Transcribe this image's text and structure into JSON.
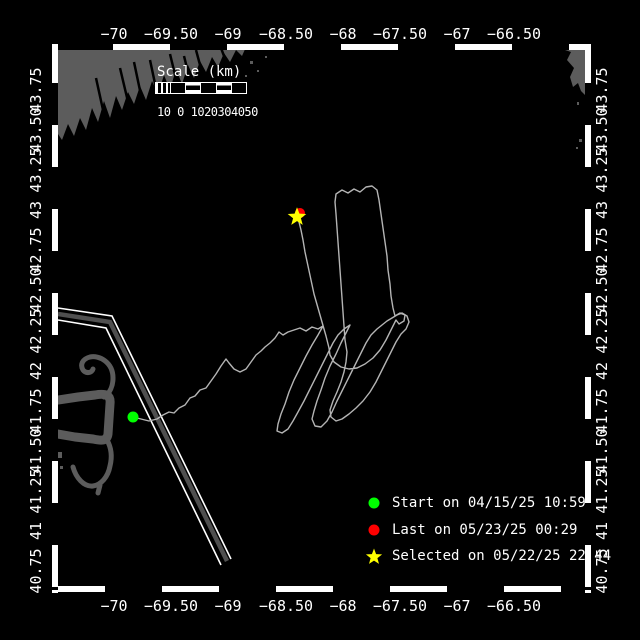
{
  "map": {
    "bg": "#000000",
    "land_color": "#5c5c5c",
    "track_color": "#b4b4b4",
    "lane_gray": "#4f4f4f",
    "frame_white": "#ffffff"
  },
  "axes": {
    "top_labels": [
      "−70",
      "−69.50",
      "−69",
      "−68.50",
      "−68",
      "−67.50",
      "−67",
      "−66.50"
    ],
    "bottom_labels": [
      "−70",
      "−69.50",
      "−69",
      "−68.50",
      "−68",
      "−67.50",
      "−67",
      "−66.50"
    ],
    "left_labels": [
      "43.75",
      "43.50",
      "43.25",
      "43",
      "42.75",
      "42.50",
      "42.25",
      "42",
      "41.75",
      "41.50",
      "41.25",
      "41",
      "40.75"
    ],
    "right_labels": [
      "43.75",
      "43.50",
      "43.25",
      "43",
      "42.75",
      "42.50",
      "42.25",
      "42",
      "41.75",
      "41.50",
      "41.25",
      "41",
      "40.75"
    ]
  },
  "scalebar": {
    "title": "Scale (km)",
    "ticks": "10 0 1020304050"
  },
  "legend": [
    {
      "label": "Start on 04/15/25 10:59",
      "color": "#00ff00",
      "marker": "dot"
    },
    {
      "label": "Last on 05/23/25 00:29",
      "color": "#ff0000",
      "marker": "dot"
    },
    {
      "label": "Selected on 05/22/25 22:44",
      "color": "#ffff00",
      "marker": "star"
    }
  ],
  "markers": {
    "start": {
      "x": "133",
      "y": "417"
    },
    "last": {
      "x": "300",
      "y": "213"
    },
    "selected": {
      "transform": "translate(297,217) scale(1.15)"
    }
  },
  "legend_markers": {
    "start": {
      "x": "374",
      "y": "509"
    },
    "last": {
      "x": "374",
      "y": "536"
    },
    "selected_transform": "translate(374,562)"
  },
  "geometry": {
    "star_points": "0,-8.5 2.1,-2.9 8.1,-2.6 3.4,1.1 5,6.9 0,3.6 -5,6.9 -3.4,1.1 -8.1,-2.6 -2.1,-2.9",
    "track": "M133,417 L141,419 149,421 157,419 163,415 169,412 174,413 179,408 185,405 190,398 195,396 200,390 206,388 211,381 216,374 221,366 226,359 229,363 234,369 240,372 246,369 251,362 256,355 261,351 265,347 270,343 275,338 279,332 283,335 288,332 294,330 300,328 306,331 312,327 318,329 323,326 318,335 312,345 306,356 300,368 294,380 289,392 285,404 281,414 278,424 277,431 282,433 288,429 293,421 298,412 304,401 310,389 316,377 322,365 328,353 333,343 338,335 344,329 350,325 346,333 341,343 336,354 330,366 325,378 321,390 317,401 314,411 312,419 315,426 321,427 327,421 332,412 337,401 343,389 349,377 355,365 361,353 366,343 371,335 377,329 382,325 387,321 392,318 397,315 402,313 407,316 409,322 406,329 401,334 396,342 391,352 386,362 381,372 376,382 370,392 363,401 356,408 349,414 342,419 336,421 331,417 330,410 333,401 337,392 341,382 344,372 346,362 347,352 345,340 344,326 343,312 342,298 341,284 340,270 339,256 338,242 337,228 336,214 335,202 336,194 342,190 348,193 354,189 360,192 366,187 372,186 377,190 379,200 381,214 383,228 385,242 387,256 388,270 390,284 391,296 393,308 395,316 400,313 405,315 404,321 399,324 396,320 391,330 386,340 380,350 373,358 365,364 357,368 349,369 341,367 334,362 330,355 329,348 326,336 322,322 318,308 314,294 311,280 308,266 305,252 303,240 301,230 299,222 297,217",
    "lane_outer": "M58,308 L112,316 231,559",
    "lane_mid": "M58,314 L110,322 227,561",
    "lane_inner": "M58,320 L106,328 221,565",
    "land_maine": "M58,47 L246,47 242,56 236,50 230,62 224,53 218,67 212,57 206,72 200,61 194,78 188,65 182,84 176,69 170,90 164,75 158,94 152,81 146,100 140,86 134,104 128,92 122,110 116,96 110,118 104,101 98,122 92,108 86,130 80,118 74,136 68,124 62,140 58,134 Z",
    "maine_inlets": "M150,60 L157,93 M170,54 L178,87 M120,68 L129,106 M196,50 L203,76 M96,78 L105,119 M134,62 L142,100 M184,56 L190,80 M221,48 L227,64",
    "land_novascotia": "M563,47 L585,47 585,95 581,91 578,83 573,87 570,77 574,68 567,60 571,52 565,50 Z",
    "islands": "M250,61 h3 v3 h-3 Z M257,70 h2 v2 h-2 Z M245,75 h2 v2 h-2 Z M265,56 h2 v2 h-2 Z M577,102 h2 v3 h-2 Z M579,139 h3 v3 h-3 Z M576,147 h2 v2 h-2 Z M58,452 h4 v6 h-4 Z M60,466 h3 v3 h-3 Z",
    "cape_arm": "M58,400 L78,397 95,395 C106,393 111,395 110,404 L108,434 C107,441 102,441 93,439 L75,437 58,434",
    "cape_curl": "M104,397 C110,393 113,386 113,378 C113,362 99,355 90,357 C82,359 80,365 83,370 C86,374 92,373 93,369",
    "cape_hook": "M107,440 C112,449 112,458 110,466 C108,477 101,485 93,486 C84,487 76,478 73,467 M100,485 L98,493"
  }
}
